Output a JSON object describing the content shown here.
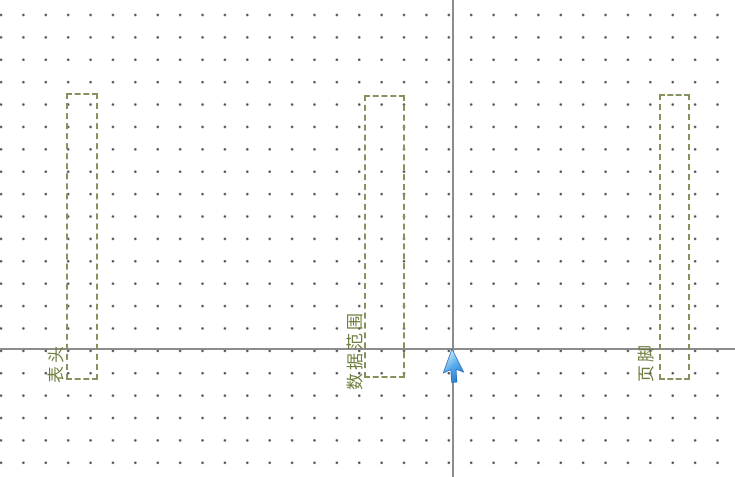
{
  "canvas": {
    "name": "report-design-surface",
    "background_color": "#ffffff",
    "grid_dot_color": "#4d4d4d",
    "guide_line_color": "#8c8c8c",
    "band_border_color": "#84935d",
    "band_label_color": "#6d7f3e"
  },
  "bands": [
    {
      "id": "header",
      "label": "表头"
    },
    {
      "id": "data_range",
      "label": "数据范围"
    },
    {
      "id": "footer",
      "label": "页脚"
    }
  ],
  "cursor": {
    "name": "blue-arrow-cursor",
    "color_light": "#cfeafc",
    "color_dark": "#1b72cc"
  }
}
